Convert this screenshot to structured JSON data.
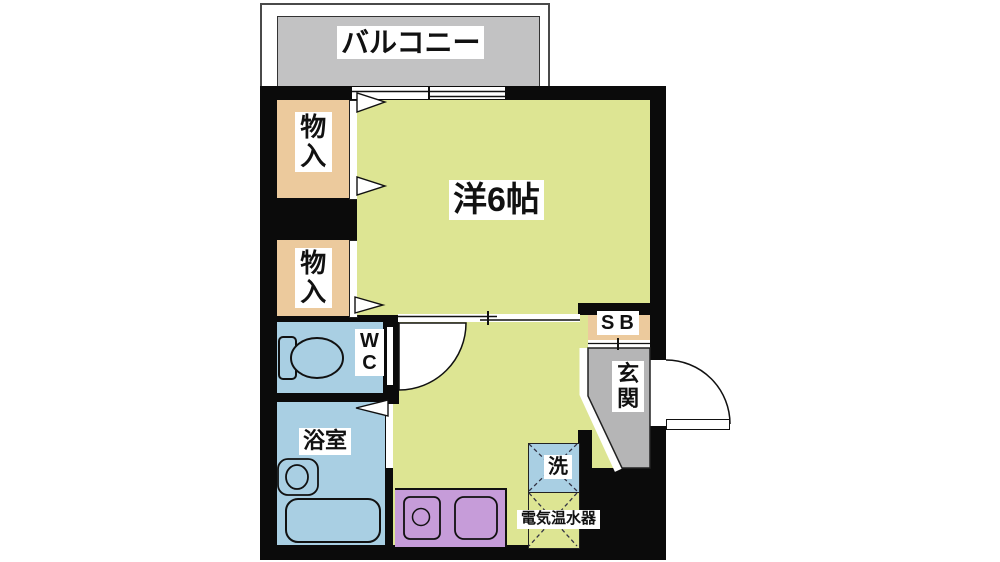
{
  "floorplan": {
    "type": "apartment-floor-plan",
    "labels": {
      "balcony": "バルコニー",
      "main_room": "洋6帖",
      "closet_top": "物入",
      "closet_bottom": "物入",
      "wc": "WC",
      "bathroom": "浴室",
      "shoe_box": "SB",
      "entrance": "玄関",
      "washing_machine": "洗",
      "water_heater": "電気温水器"
    },
    "colors": {
      "wall": "#0b0b0b",
      "room-yellow": "#dde593",
      "closet-tan": "#ecca9d",
      "wet-blue": "#a9cfe3",
      "kitchen-purple": "#c69cd9",
      "balcony-gray": "#c2c2c3",
      "entrance-gray": "#b5b5b6",
      "label-bg": "#ffffff",
      "line": "#111111"
    }
  }
}
